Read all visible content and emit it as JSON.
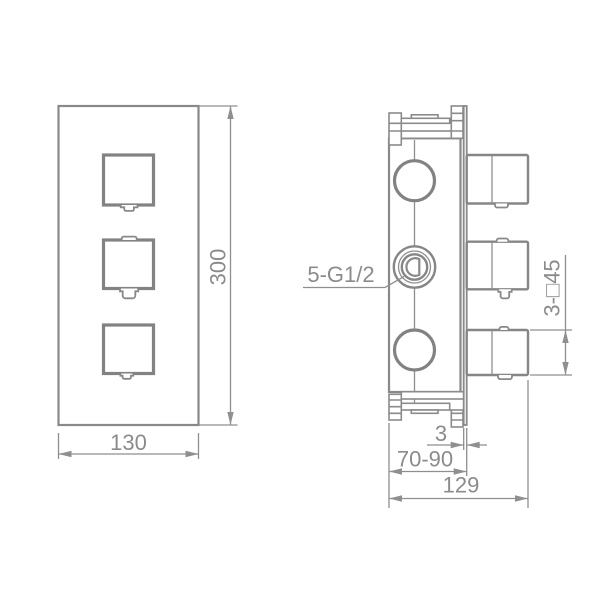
{
  "front_view": {
    "width_mm": "130",
    "height_mm": "300"
  },
  "side_view": {
    "inlet_thread": "5-G1/2",
    "handle_square": "3-□45",
    "plate_thickness_mm": "3",
    "embed_depth_range_mm": "70-90",
    "overall_depth_mm": "129"
  },
  "colors": {
    "line": "#8b8b8b",
    "background": "#ffffff"
  }
}
